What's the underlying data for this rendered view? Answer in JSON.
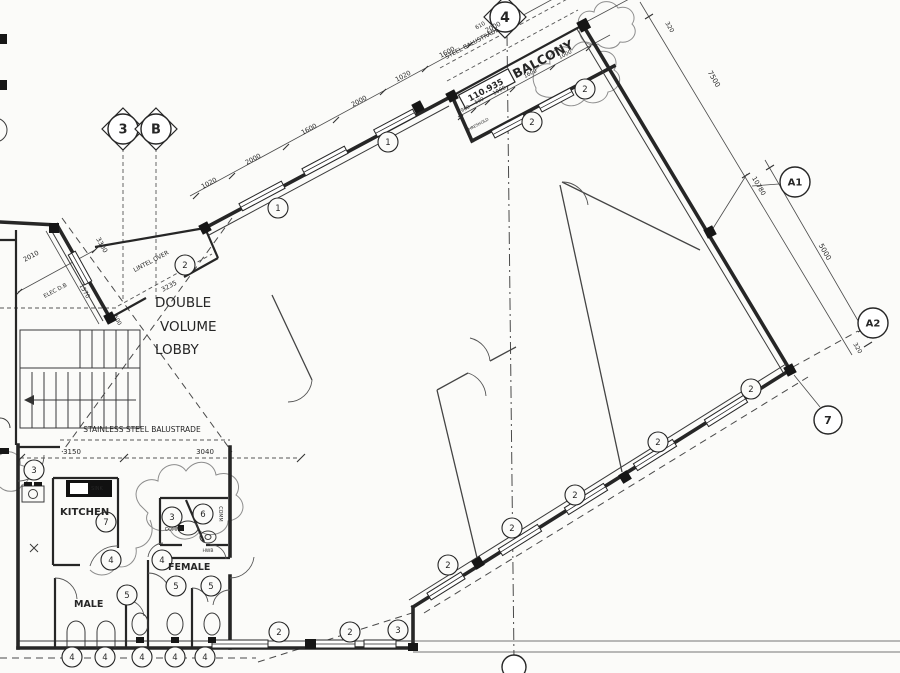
{
  "colors": {
    "ink": "#262626",
    "paper": "#fbfbf9"
  },
  "drawing": {
    "level_marker": {
      "value": "110.935"
    },
    "grid_markers": [
      {
        "v": "3",
        "x": 123,
        "y": 129,
        "r": 15,
        "fs": 13,
        "diamond": true
      },
      {
        "v": "B",
        "x": 156,
        "y": 129,
        "r": 15,
        "fs": 13,
        "diamond": true
      },
      {
        "v": "4",
        "x": 505,
        "y": 17,
        "r": 15,
        "fs": 14,
        "diamond": true
      },
      {
        "v": "A1",
        "x": 795,
        "y": 182,
        "r": 15,
        "fs": 10
      },
      {
        "v": "A2",
        "x": 873,
        "y": 323,
        "r": 15,
        "fs": 10
      },
      {
        "v": "7",
        "x": 828,
        "y": 420,
        "r": 14,
        "fs": 11
      },
      {
        "v": "",
        "x": 514,
        "y": 667,
        "r": 12,
        "fs": 11
      }
    ],
    "keynotes": [
      {
        "v": "1",
        "x": 278,
        "y": 208
      },
      {
        "v": "1",
        "x": 388,
        "y": 142
      },
      {
        "v": "2",
        "x": 185,
        "y": 265
      },
      {
        "v": "2",
        "x": 532,
        "y": 122
      },
      {
        "v": "2",
        "x": 585,
        "y": 89
      },
      {
        "v": "2",
        "x": 448,
        "y": 565
      },
      {
        "v": "2",
        "x": 512,
        "y": 528
      },
      {
        "v": "2",
        "x": 575,
        "y": 495
      },
      {
        "v": "2",
        "x": 658,
        "y": 442
      },
      {
        "v": "2",
        "x": 751,
        "y": 389
      },
      {
        "v": "2",
        "x": 279,
        "y": 632
      },
      {
        "v": "2",
        "x": 350,
        "y": 632
      },
      {
        "v": "3",
        "x": 398,
        "y": 630
      },
      {
        "v": "3",
        "x": 34,
        "y": 470
      },
      {
        "v": "3",
        "x": 172,
        "y": 517
      },
      {
        "v": "4",
        "x": 72,
        "y": 657
      },
      {
        "v": "4",
        "x": 105,
        "y": 657
      },
      {
        "v": "4",
        "x": 142,
        "y": 657
      },
      {
        "v": "4",
        "x": 175,
        "y": 657
      },
      {
        "v": "4",
        "x": 205,
        "y": 657
      },
      {
        "v": "4",
        "x": 111,
        "y": 560
      },
      {
        "v": "4",
        "x": 162,
        "y": 560
      },
      {
        "v": "5",
        "x": 127,
        "y": 595
      },
      {
        "v": "5",
        "x": 176,
        "y": 586
      },
      {
        "v": "5",
        "x": 211,
        "y": 586
      },
      {
        "v": "6",
        "x": 203,
        "y": 514
      },
      {
        "v": "7",
        "x": 106,
        "y": 522
      }
    ],
    "texts": [
      {
        "n": "room-label-lobby-1",
        "t": "DOUBLE",
        "x": 155,
        "y": 307,
        "s": 13.5,
        "a": "start"
      },
      {
        "n": "room-label-lobby-2",
        "t": "VOLUME",
        "x": 160,
        "y": 331,
        "s": 13.5,
        "a": "start"
      },
      {
        "n": "room-label-lobby-3",
        "t": "LOBBY",
        "x": 155,
        "y": 354,
        "s": 13.5,
        "a": "start"
      },
      {
        "n": "room-label-kitchen",
        "t": "KITCHEN",
        "x": 60,
        "y": 515,
        "s": 10,
        "a": "start",
        "w": 600
      },
      {
        "n": "room-label-male",
        "t": "MALE",
        "x": 74,
        "y": 607,
        "s": 9.5,
        "a": "start",
        "w": 600
      },
      {
        "n": "room-label-female",
        "t": "FEMALE",
        "x": 168,
        "y": 570,
        "s": 9.5,
        "a": "start",
        "w": 600
      },
      {
        "n": "room-label-balcony",
        "t": "BALCONY",
        "x": 545,
        "y": 63,
        "s": 12.5,
        "r": -28,
        "w": 700
      },
      {
        "n": "room-label-comms",
        "t": "COMMS",
        "x": 174,
        "y": 531,
        "s": 4.8
      },
      {
        "n": "room-label-comm",
        "t": "COMM",
        "x": 219,
        "y": 514,
        "s": 4.8,
        "r": 90
      },
      {
        "n": "fixture-label-hwb",
        "t": "HWB",
        "x": 208,
        "y": 552,
        "s": 4.5
      },
      {
        "n": "fixture-label-sink",
        "t": "SINK",
        "x": 97,
        "y": 490,
        "s": 5,
        "f": "#ffffff"
      },
      {
        "n": "label-elec-db",
        "t": "ELEC D.B",
        "x": 56,
        "y": 292,
        "s": 5.5,
        "r": -28
      },
      {
        "n": "anno-steel-balustrade",
        "t": "STEEL BALUSTRADE",
        "x": 473,
        "y": 45,
        "s": 6,
        "r": -28
      },
      {
        "n": "anno-stainless-balustrade",
        "t": "STAINLESS STEEL BALUSTRADE",
        "x": 142,
        "y": 432,
        "s": 7.5
      },
      {
        "n": "anno-lintel-over",
        "t": "LINTEL OVER",
        "x": 152,
        "y": 263,
        "s": 6,
        "r": -28
      },
      {
        "n": "anno-threshold",
        "t": "THRESHOLD",
        "x": 478,
        "y": 126,
        "s": 4,
        "r": -28
      },
      {
        "n": "dim-label",
        "t": "610",
        "x": 481,
        "y": 27,
        "s": 5.5,
        "r": -28
      },
      {
        "n": "level-value",
        "t": "110.935",
        "x": 487,
        "y": 92.5,
        "s": 8.5,
        "r": -28,
        "w": 600
      },
      {
        "n": "dim-label",
        "t": "1020",
        "x": 210,
        "y": 185,
        "s": 6.5,
        "r": -28
      },
      {
        "n": "dim-label",
        "t": "2000",
        "x": 254,
        "y": 161,
        "s": 6.5,
        "r": -28
      },
      {
        "n": "dim-label",
        "t": "1600",
        "x": 310,
        "y": 131,
        "s": 6.5,
        "r": -28
      },
      {
        "n": "dim-label",
        "t": "2000",
        "x": 360,
        "y": 103,
        "s": 6.5,
        "r": -28
      },
      {
        "n": "dim-label",
        "t": "1020",
        "x": 404,
        "y": 78,
        "s": 6.5,
        "r": -28
      },
      {
        "n": "dim-label",
        "t": "1600",
        "x": 448,
        "y": 54,
        "s": 6.5,
        "r": -28
      },
      {
        "n": "dim-label",
        "t": "2000",
        "x": 494,
        "y": 29,
        "s": 6.5,
        "r": -28
      },
      {
        "n": "dim-label",
        "t": "960",
        "x": 466,
        "y": 110,
        "s": 5,
        "r": -28
      },
      {
        "n": "dim-label",
        "t": "500",
        "x": 480,
        "y": 102,
        "s": 5,
        "r": -28
      },
      {
        "n": "dim-label",
        "t": "1000",
        "x": 500,
        "y": 92,
        "s": 5.5,
        "r": -28
      },
      {
        "n": "dim-label",
        "t": "1600",
        "x": 531,
        "y": 75,
        "s": 5.5,
        "r": -28
      },
      {
        "n": "dim-label",
        "t": "1000",
        "x": 566,
        "y": 56,
        "s": 5.5,
        "r": -28
      },
      {
        "n": "dim-label",
        "t": "320",
        "x": 668,
        "y": 28,
        "s": 6,
        "r": 60
      },
      {
        "n": "dim-label",
        "t": "7500",
        "x": 712,
        "y": 80,
        "s": 7,
        "r": 60
      },
      {
        "n": "dim-label",
        "t": "10780",
        "x": 757,
        "y": 187,
        "s": 6.5,
        "r": 60
      },
      {
        "n": "dim-label",
        "t": "5000",
        "x": 823,
        "y": 253,
        "s": 7,
        "r": 60
      },
      {
        "n": "dim-label",
        "t": "320",
        "x": 856,
        "y": 349,
        "s": 6,
        "r": 60
      },
      {
        "n": "dim-label",
        "t": "2010",
        "x": 32,
        "y": 258,
        "s": 6.5,
        "r": -28
      },
      {
        "n": "dim-label",
        "t": "3300",
        "x": 100,
        "y": 246,
        "s": 6.5,
        "r": 61
      },
      {
        "n": "dim-label",
        "t": "1570",
        "x": 83,
        "y": 292,
        "s": 6,
        "r": 61
      },
      {
        "n": "dim-label",
        "t": "500",
        "x": 116,
        "y": 321,
        "s": 5.5,
        "r": 61
      },
      {
        "n": "dim-label",
        "t": "3235",
        "x": 170,
        "y": 288,
        "s": 6.5,
        "r": -28
      },
      {
        "n": "dim-label",
        "t": "3150",
        "x": 72,
        "y": 454,
        "s": 7
      },
      {
        "n": "dim-label",
        "t": "3040",
        "x": 205,
        "y": 454,
        "s": 7
      }
    ]
  }
}
